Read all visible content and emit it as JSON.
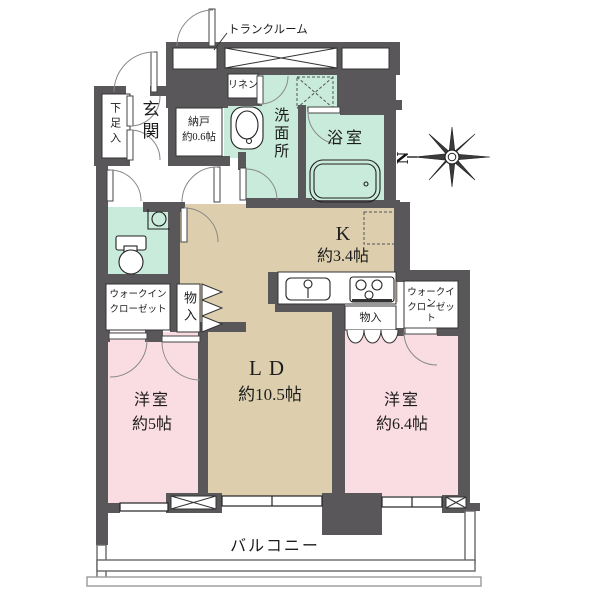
{
  "plan": {
    "title_hint": "Japanese apartment floor plan",
    "labels": {
      "trunk_room": "トランクルーム",
      "genkan": "玄関",
      "shoe_box": "下足入",
      "storage_room": "納戸",
      "storage_room_size": "約0.6帖",
      "linen": "リネン",
      "washroom": "洗面所",
      "bathroom": "浴室",
      "kitchen": "K",
      "kitchen_size": "約3.4帖",
      "living_dining": "LD",
      "living_dining_size": "約10.5帖",
      "wic_left_line1": "ウォークイン",
      "wic_left_line2": "クローゼット",
      "wic_right_line1": "ウォークイン",
      "wic_right_line2": "クローゼット",
      "closet_left": "物入",
      "closet_right": "物入",
      "bedroom_left": "洋室",
      "bedroom_left_size": "約5帖",
      "bedroom_right": "洋室",
      "bedroom_right_size": "約6.4帖",
      "balcony": "バルコニー",
      "compass_north": "N"
    },
    "colors": {
      "wall": "#595759",
      "room_tan": "#ddcfae",
      "room_pink": "#fadce3",
      "room_mint": "#c9ebdc",
      "line": "#333333"
    }
  }
}
